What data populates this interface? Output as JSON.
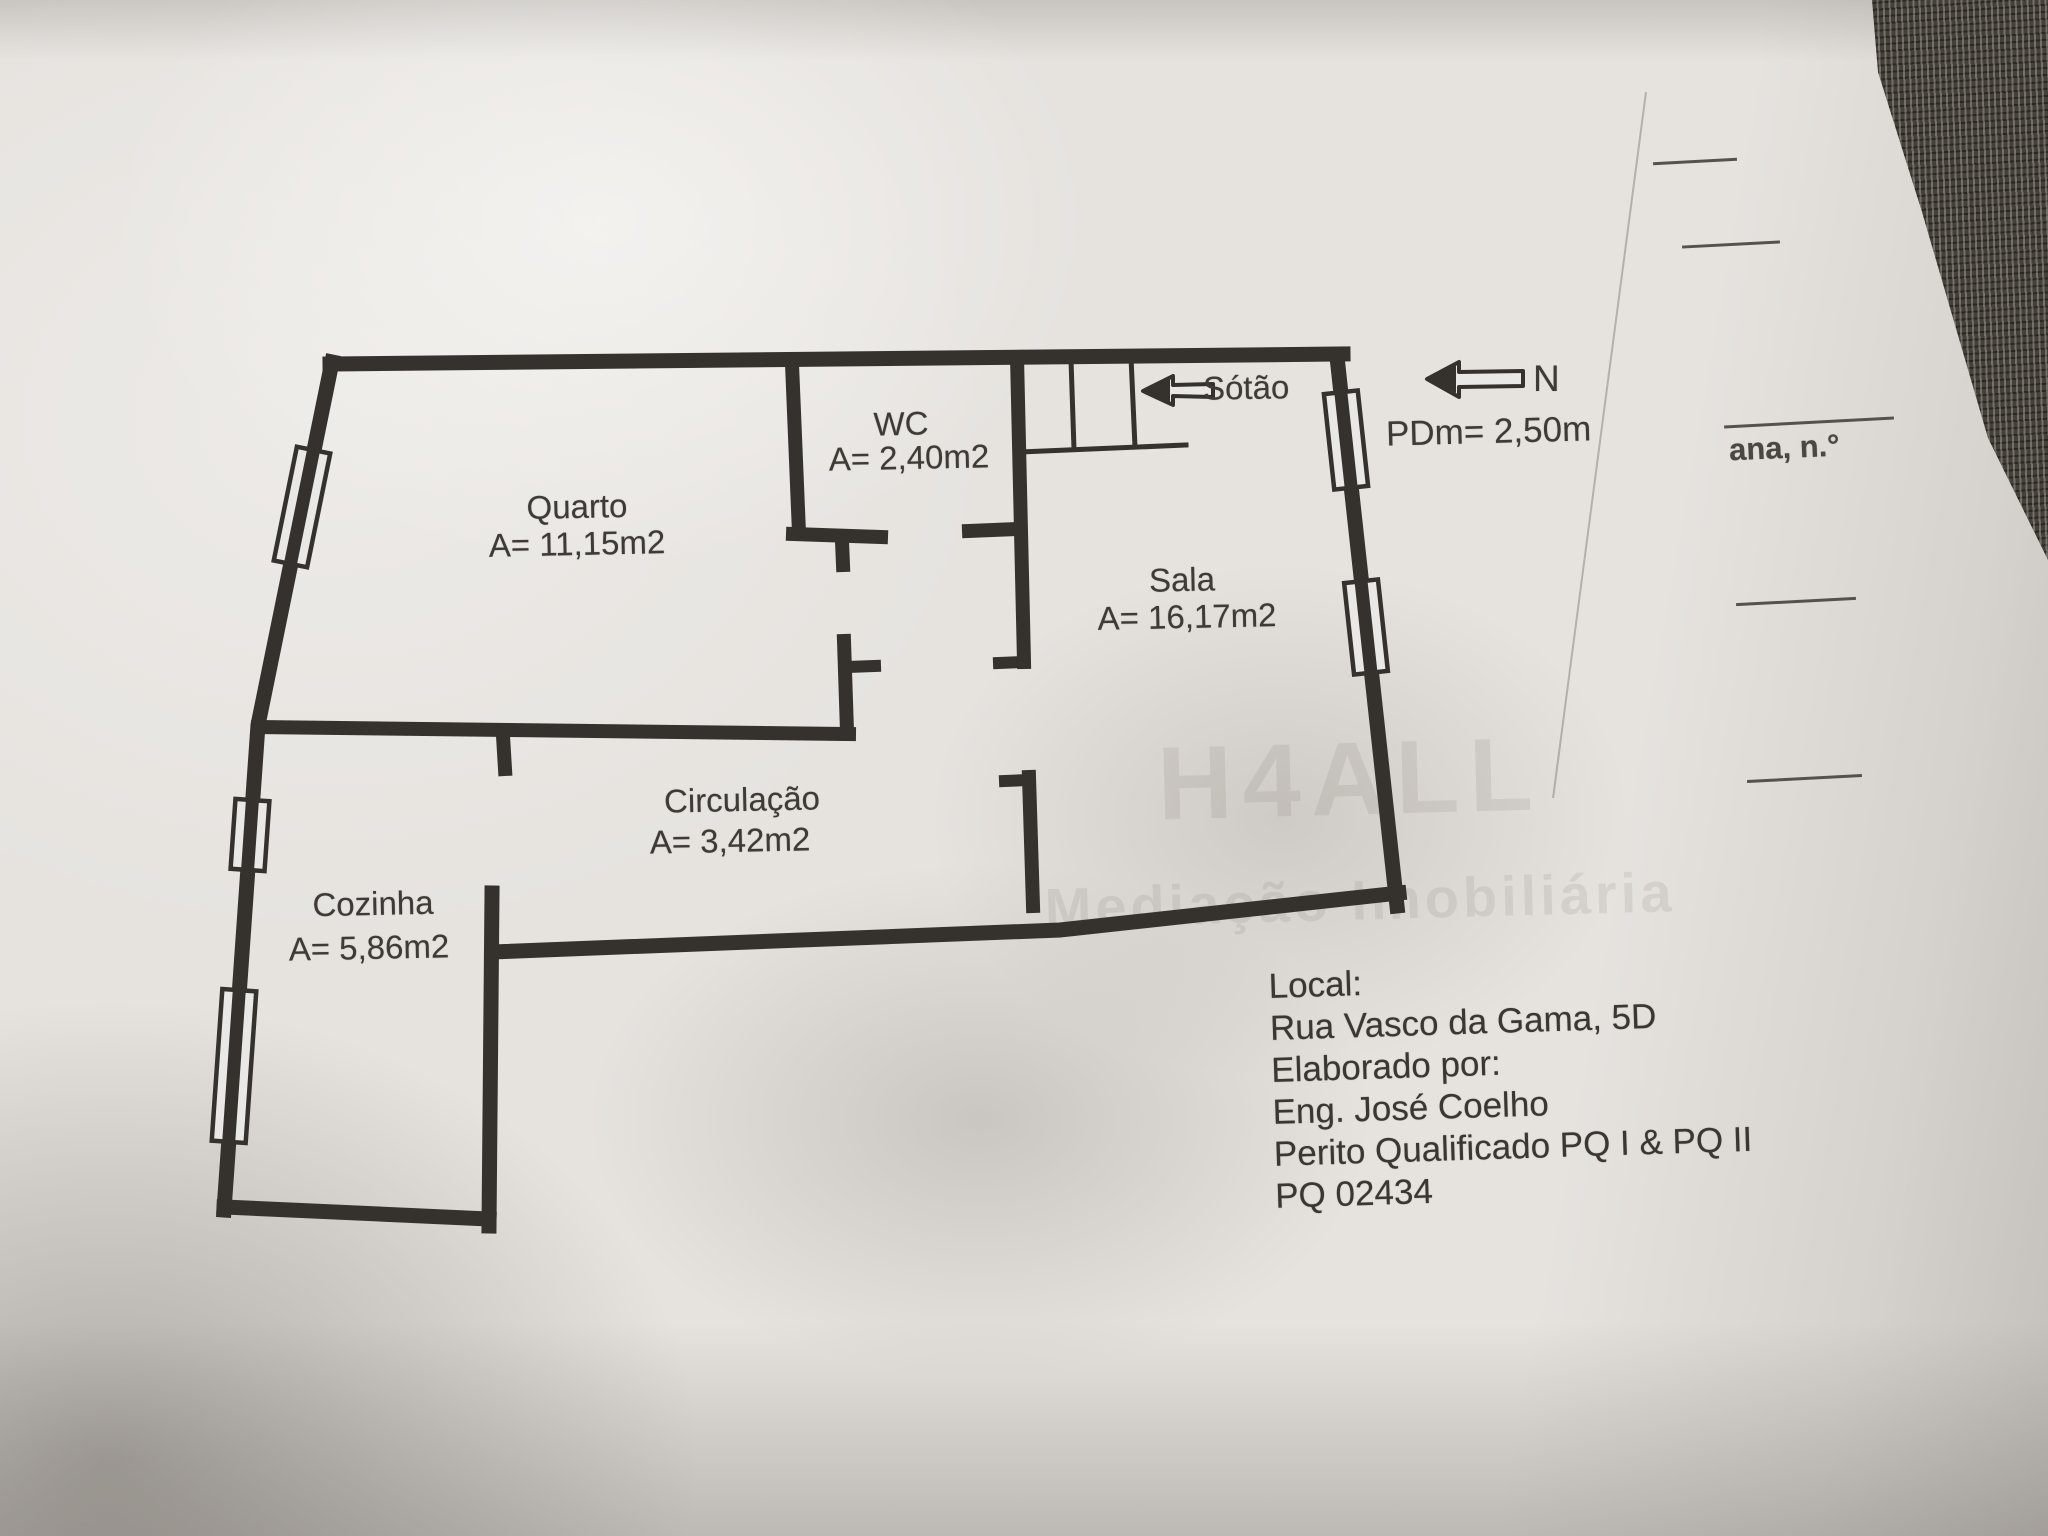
{
  "plan": {
    "rooms": [
      {
        "id": "quarto",
        "name": "Quarto",
        "area": "A= 11,15m2"
      },
      {
        "id": "wc",
        "name": "WC",
        "area": "A= 2,40m2"
      },
      {
        "id": "sala",
        "name": "Sala",
        "area": "A= 16,17m2"
      },
      {
        "id": "circulacao",
        "name": "Circulação",
        "area": "A= 3,42m2"
      },
      {
        "id": "cozinha",
        "name": "Cozinha",
        "area": "A= 5,86m2"
      }
    ],
    "annotations": {
      "sotao_label": "Sótão",
      "north_label": "N",
      "ceiling_height": "PDm= 2,50m"
    },
    "colors": {
      "wall": "#35322e",
      "paper": "#e6e3df",
      "ink": "#3e3b36"
    }
  },
  "info_block": {
    "local_label": "Local:",
    "address": "Rua Vasco da Gama, 5D",
    "elaborado_label": "Elaborado por:",
    "author": "Eng. José Coelho",
    "qualification": "Perito Qualificado PQ I & PQ II",
    "registration": "PQ 02434"
  },
  "background_page": {
    "partial_text": "ana, n.°"
  },
  "watermark": {
    "line1": "H4ALL",
    "line2": "Mediação Imobiliária"
  }
}
